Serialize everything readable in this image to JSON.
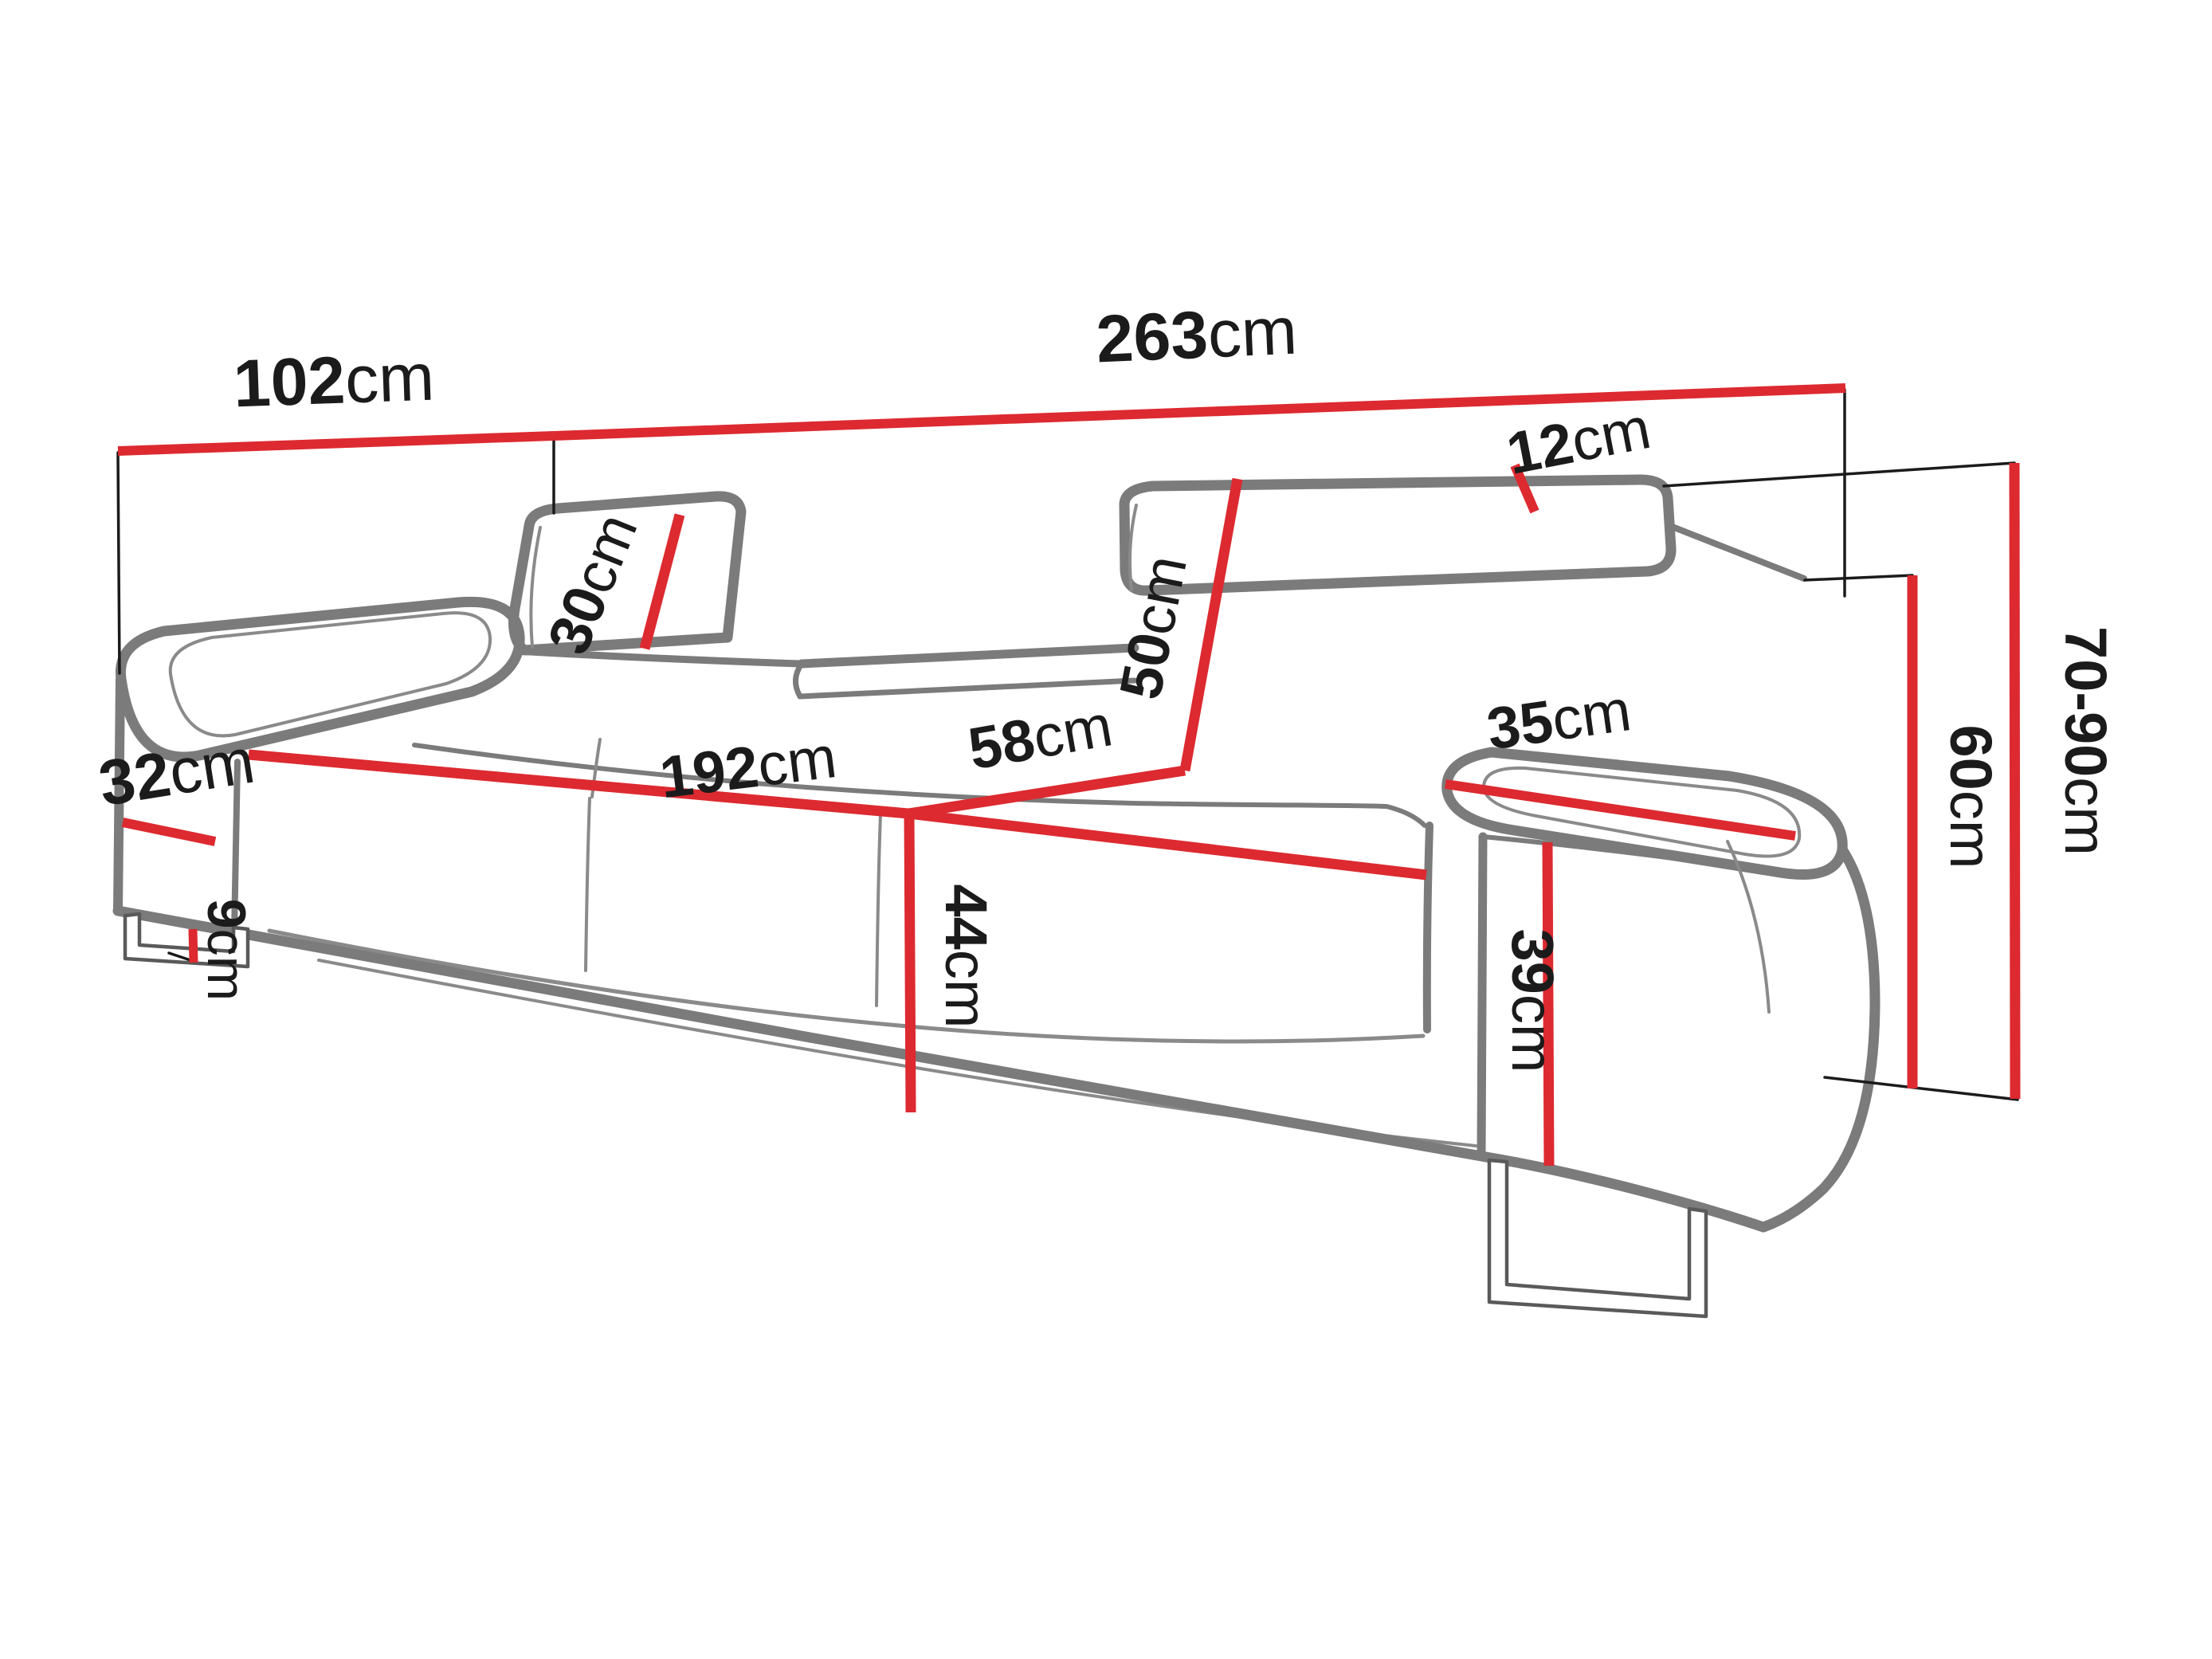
{
  "diagram": {
    "type": "furniture-dimension-diagram",
    "subject": "three-seat sofa with adjustable headrests, line drawing with red dimension lines",
    "unit": "cm",
    "colors": {
      "dimension_line": "#dc2a30",
      "sofa_outline": "#7b7b7b",
      "reference_line": "#1b1b1b",
      "text": "#1b1b1b",
      "background": "#ffffff"
    },
    "dimensions": {
      "depth_overall": {
        "value": "102",
        "unit": "cm"
      },
      "width_overall": {
        "value": "263",
        "unit": "cm"
      },
      "headrest_height": {
        "value": "30",
        "unit": "cm"
      },
      "backrest_height": {
        "value": "50",
        "unit": "cm"
      },
      "headrest_thickness": {
        "value": "12",
        "unit": "cm"
      },
      "armrest_depth_left": {
        "value": "32",
        "unit": "cm"
      },
      "seat_width": {
        "value": "192",
        "unit": "cm"
      },
      "seat_depth": {
        "value": "58",
        "unit": "cm"
      },
      "seat_height": {
        "value": "44",
        "unit": "cm"
      },
      "leg_height": {
        "value": "9",
        "unit": "cm"
      },
      "armrest_width_top": {
        "value": "35",
        "unit": "cm"
      },
      "armrest_front_height": {
        "value": "39",
        "unit": "cm"
      },
      "armrest_height": {
        "value": "60",
        "unit": "cm"
      },
      "total_height": {
        "value": "70-90",
        "unit": "cm"
      }
    }
  }
}
